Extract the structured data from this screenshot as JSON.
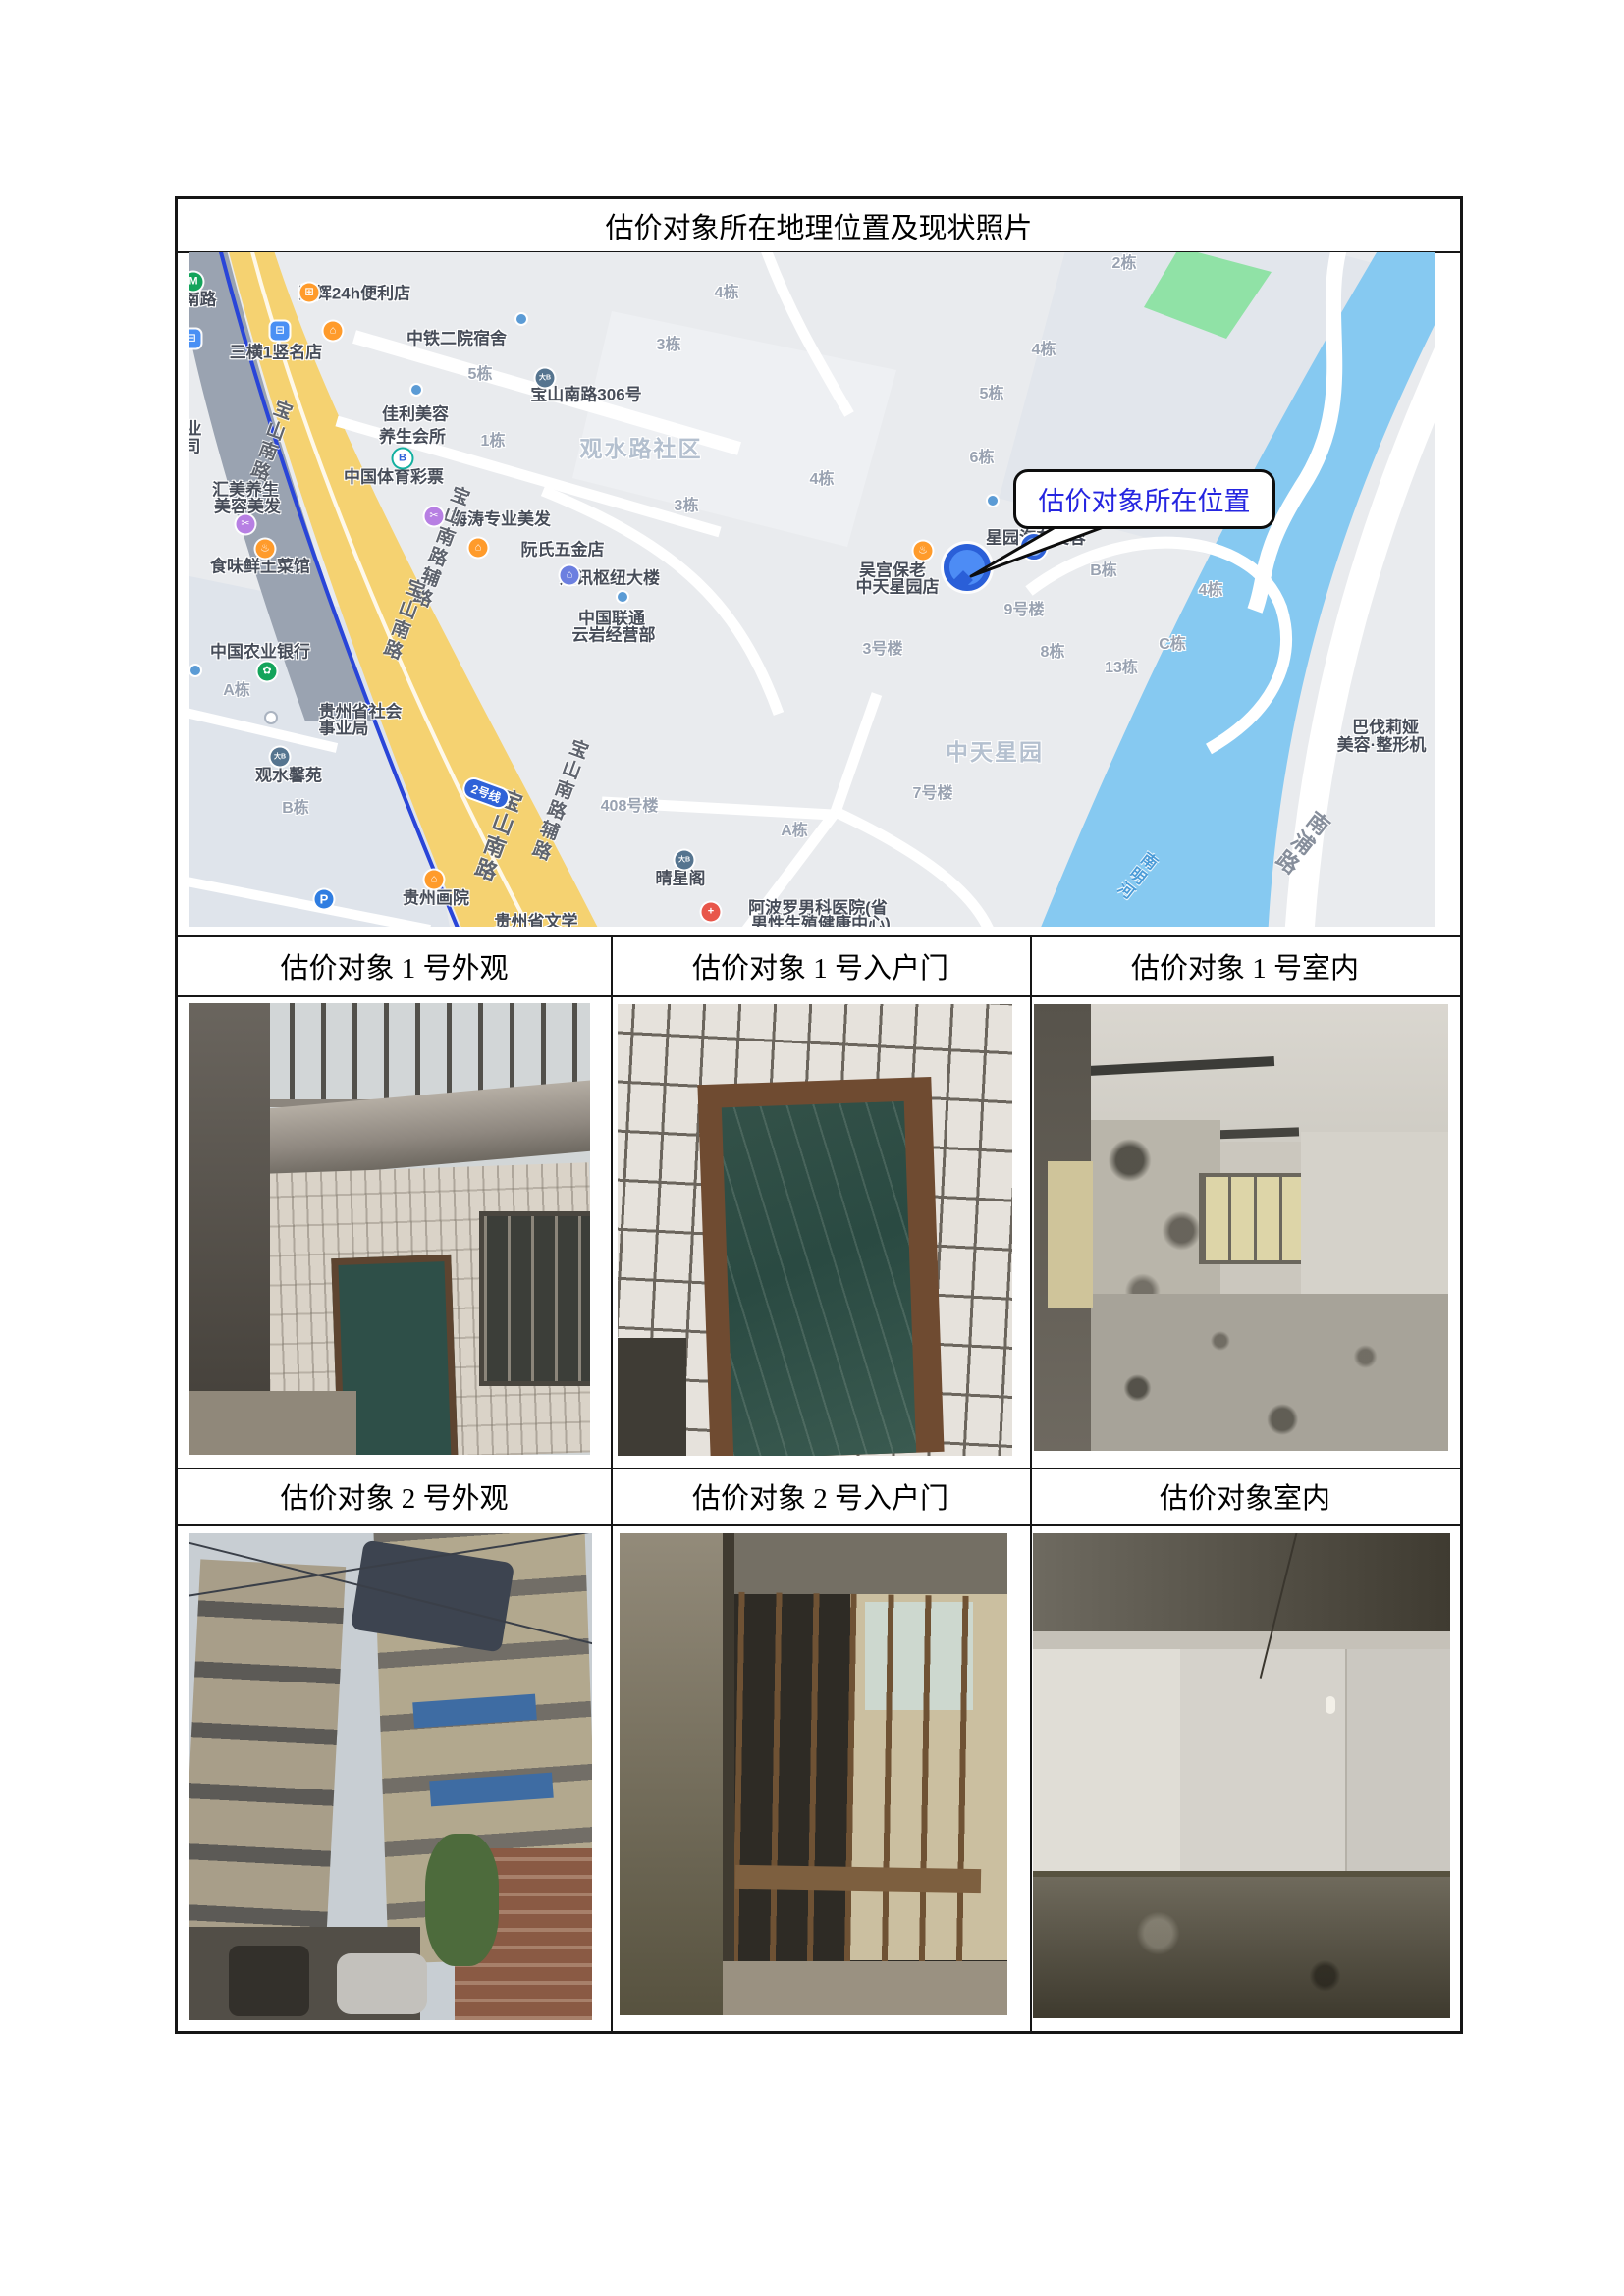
{
  "document": {
    "title": "估价对象所在地理位置及现状照片"
  },
  "photo_table": {
    "row1_headers": [
      "估价对象 1 号外观",
      "估价对象 1 号入户门",
      "估价对象 1 号室内"
    ],
    "row2_headers": [
      "估价对象 2 号外观",
      "估价对象 2 号入户门",
      "估价对象室内"
    ]
  },
  "map": {
    "callout": {
      "text": "估价对象所在位置",
      "text_color": "#2525e0"
    },
    "metro_line_badge": "2号线",
    "colors": {
      "road_yellow": "#f5d271",
      "river_blue": "#86c9f1",
      "park_green": "#90e2a6",
      "metro_blue": "#2945d8",
      "background": "#e9ebee"
    },
    "labels": [
      "山南路",
      "凯辉24h便利店",
      "三横1竖名店",
      "中铁二院宿舍",
      "5栋",
      "宝山南路306号",
      "佳利美容",
      "养生会所",
      "1栋",
      "观水路社区",
      "业",
      "司",
      "中国体育彩票",
      "汇美养生",
      "美容美发",
      "食味鲜土菜馆",
      "海涛专业美发",
      "阮氏五金店",
      "通讯枢纽大楼",
      "中国联通",
      "云岩经营部",
      "中国农业银行",
      "A栋",
      "贵州省社会",
      "事业局",
      "观水馨苑",
      "B栋",
      "贵州画院",
      "贵州省文学",
      "408号楼",
      "A栋",
      "晴星阁",
      "阿波罗男科医院(省",
      "男性生殖健康中心)",
      "7号楼",
      "中天星园",
      "3栋",
      "4栋",
      "4栋",
      "3栋",
      "5栋",
      "6栋",
      "2栋",
      "4栋",
      "吴宫保老",
      "中天星园店",
      "星园汽车美容",
      "9号楼",
      "3号楼",
      "8栋",
      "B栋",
      "4栋",
      "C栋",
      "13栋",
      "巴伐莉娅",
      "美容·整形机",
      "南明河",
      "南浦路",
      "宝山南路",
      "宝山南路辅路",
      "宝山南路",
      "宝山南路",
      "宝山南路辅路"
    ],
    "icons": [
      "M",
      "⊟",
      "⊟",
      "⊞",
      "⌂",
      "大B",
      "B",
      "✂",
      "♨",
      "✂",
      "⌂",
      "⌂",
      "✿",
      "大B",
      "⌂",
      "P",
      "♨",
      "大B",
      "+"
    ]
  }
}
